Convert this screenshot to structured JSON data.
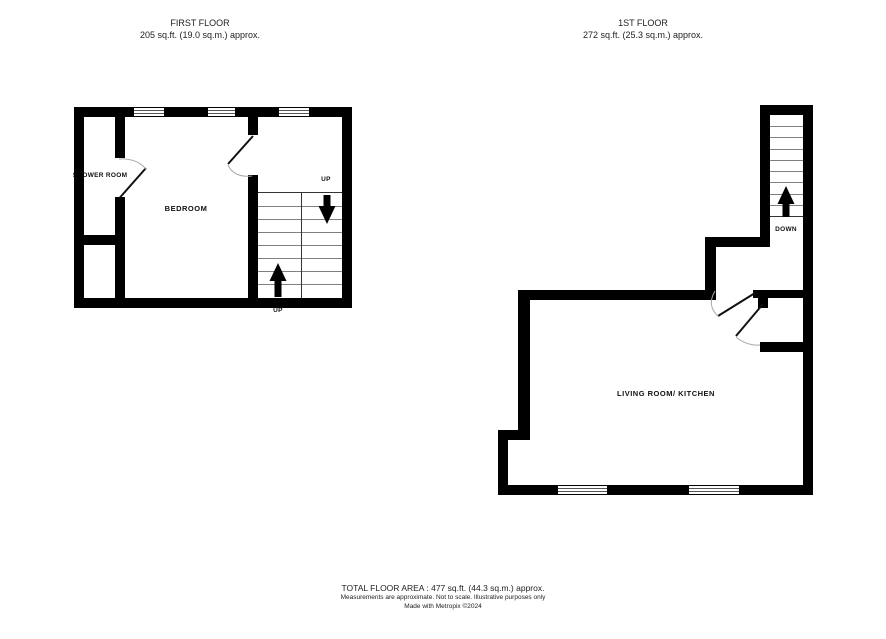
{
  "plans": [
    {
      "title": "FIRST FLOOR",
      "area": "205 sq.ft. (19.0 sq.m.) approx.",
      "rooms": [
        {
          "name": "SHOWER ROOM"
        },
        {
          "name": "BEDROOM"
        }
      ],
      "stair_labels": {
        "top": "UP",
        "bottom": "UP"
      }
    },
    {
      "title": "1ST FLOOR",
      "area": "272 sq.ft. (25.3 sq.m.) approx.",
      "rooms": [
        {
          "name": "LIVING ROOM/ KITCHEN"
        }
      ],
      "stair_labels": {
        "down": "DOWN"
      }
    }
  ],
  "footer": {
    "total_area": "TOTAL FLOOR AREA : 477 sq.ft. (44.3 sq.m.) approx.",
    "disclaimer": "Measurements are approximate.  Not to scale.  Illustrative purposes only",
    "credit": "Made with Metropix ©2024"
  },
  "colors": {
    "wall": "#000000",
    "background": "#ffffff",
    "text": "#222222",
    "tread_line": "#808080",
    "door_arc": "#aaaaaa"
  }
}
